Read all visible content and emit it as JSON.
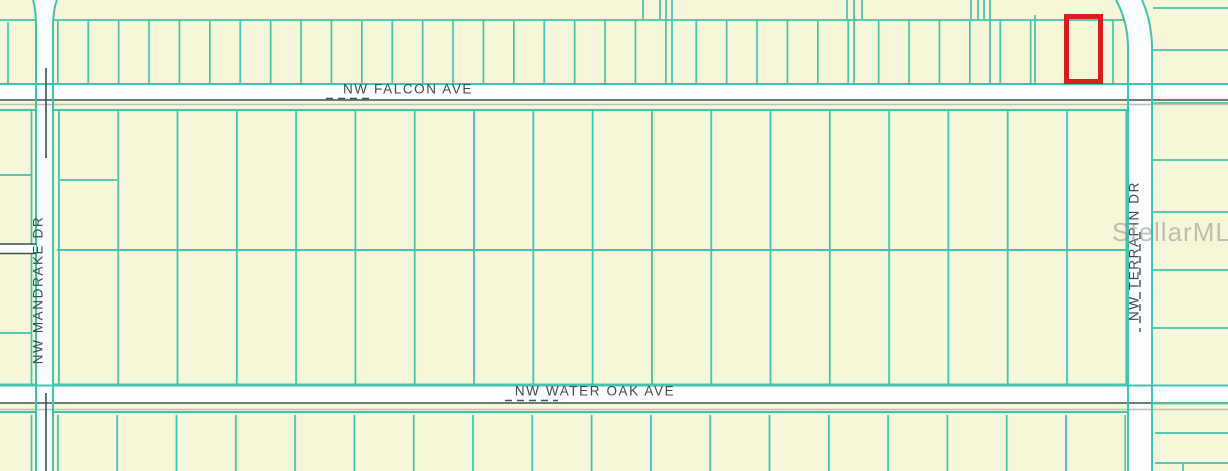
{
  "map": {
    "street_labels": {
      "falcon_ave": "NW FALCON AVE",
      "water_oak_ave": "NW WATER OAK AVE",
      "mandrake_dr": "NW MANDRAKE DR",
      "terrapin_dr": "NW TERRAPIN DR"
    },
    "watermark": "StellarMLS",
    "colors": {
      "background": "#f6f7d8",
      "parcel_line": "#41c4af",
      "road_fill": "#fbfdfe",
      "road_dark_line": "#3a5552",
      "road_gray_line": "#bfbfb2",
      "highlight": "#dd1c1c",
      "label_text": "#45484e",
      "watermark_color": "#8f8f8f"
    }
  }
}
